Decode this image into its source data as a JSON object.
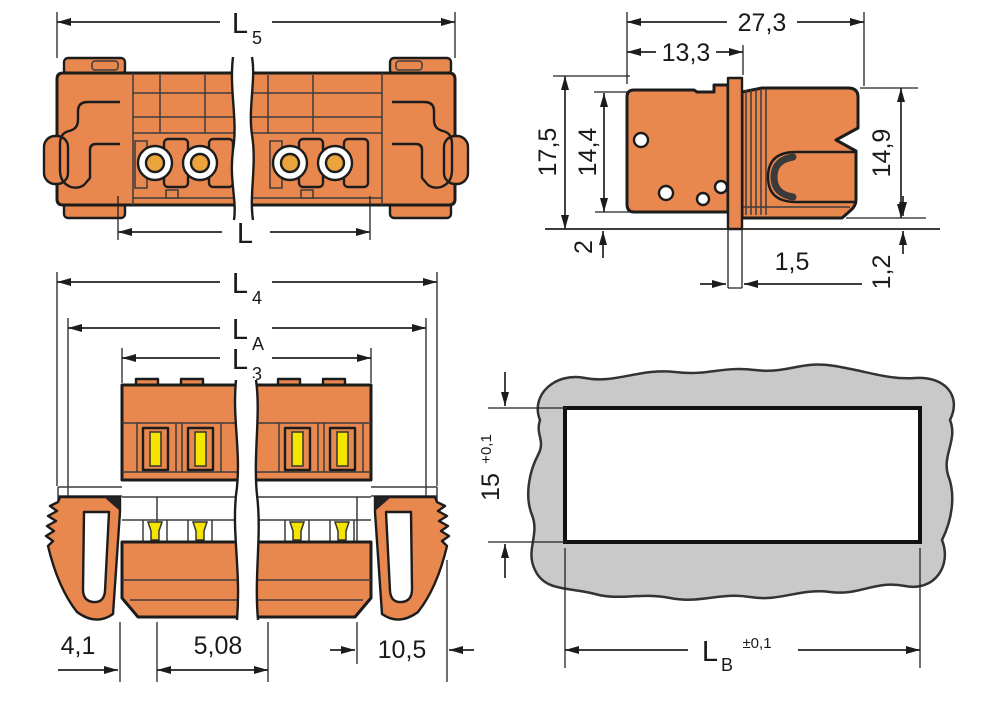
{
  "views": {
    "top": {
      "dims": {
        "l5": {
          "base": "L",
          "sub": "5"
        },
        "l": "L"
      }
    },
    "side": {
      "dims": {
        "overall_width": "27,3",
        "front_width": "13,3",
        "overall_height": "17,5",
        "body_height": "14,4",
        "right_height": "14,9",
        "pin_length": "2",
        "flange_thickness": "1,5",
        "panel_gap": "1,2"
      }
    },
    "front": {
      "dims": {
        "l4": {
          "base": "L",
          "sub": "4"
        },
        "la": {
          "base": "L",
          "sub": "A"
        },
        "l3": {
          "base": "L",
          "sub": "3"
        },
        "edge_offset": "4,1",
        "pitch": "5,08",
        "lever_width": "10,5"
      }
    },
    "cutout": {
      "dims": {
        "height": "15",
        "height_tol": "+0,1",
        "width_base": "L",
        "width_sub": "B",
        "width_tol": "±0,1"
      }
    }
  },
  "colors": {
    "housing_orange": "#E8874E",
    "contact_amber": "#EBA33C",
    "lever_yellow": "#F5E400",
    "panel_gray": "#C9C9C9",
    "outline": "#1C1C1C",
    "dimension": "#1F1F1F"
  }
}
